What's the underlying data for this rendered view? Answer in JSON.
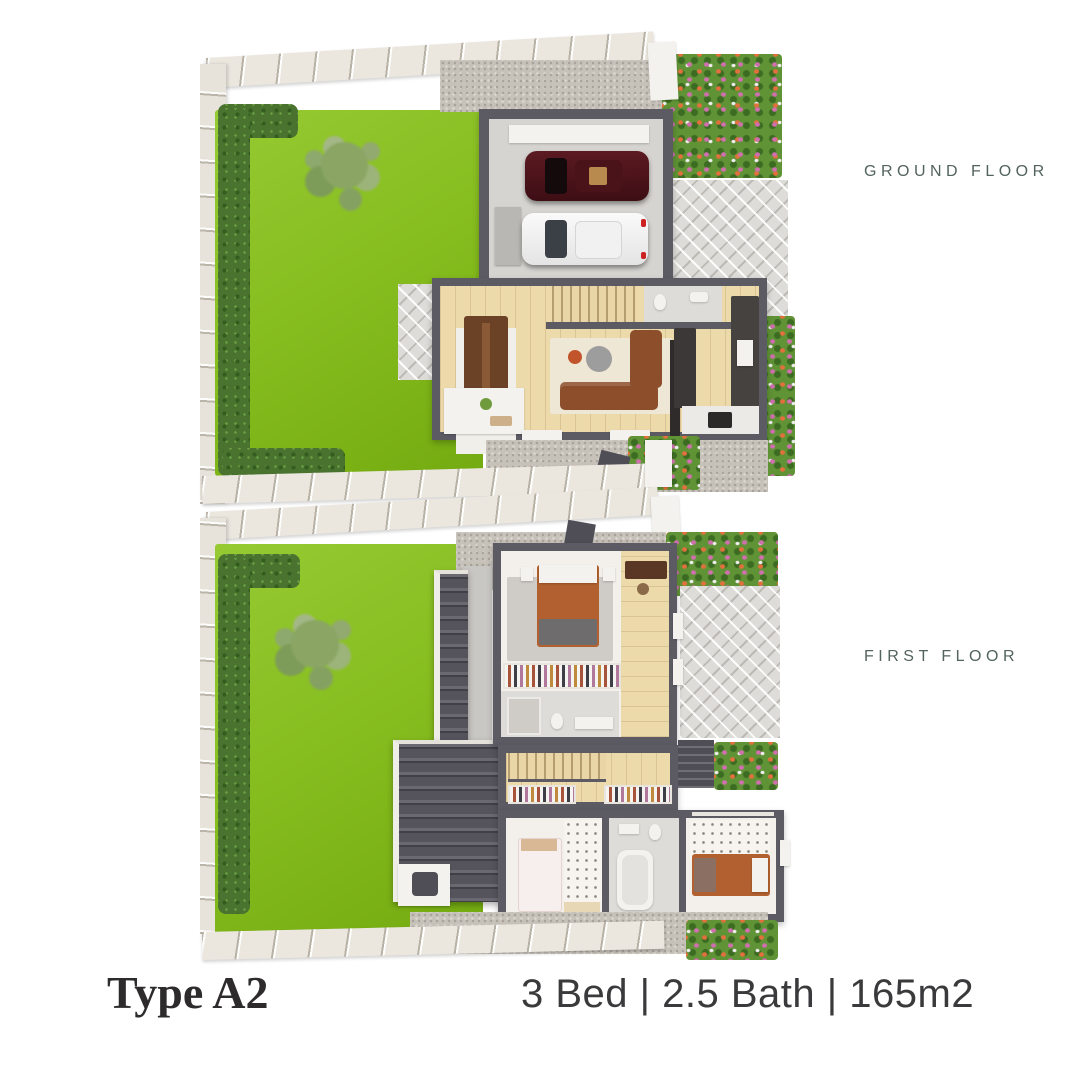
{
  "artboard": {
    "width": 1080,
    "height": 1080,
    "background": "#ffffff"
  },
  "floor_plans": [
    {
      "label": "GROUND FLOOR",
      "depicts": "lawn with tree and hedge, double garage with two cars, driveway, open-plan kitchen dining living room, wc, stairs, entry porch, paved patio and flower beds"
    },
    {
      "label": "FIRST FLOOR",
      "depicts": "lawn with tree and hedge, master bedroom with wardrobe and bathroom, two further bedrooms, bathroom with tub, stairs, landing, garage roof with skylight, paved terrace and flower beds"
    }
  ],
  "footer": {
    "type": "Type A2",
    "specs": "3 Bed | 2.5 Bath | 165m2"
  },
  "palette": {
    "lawn": "#87be20",
    "hedge": "#4a7330",
    "tree": "#8aa468",
    "fence": "#ebe7df",
    "wall": "#5c5b64",
    "wood_floor": "#eddaab",
    "gravel": "#c6c1b9",
    "paving": "#dedcd8",
    "roof": "#55545d",
    "interior": "#f3f0eb",
    "sofa": "#8c4e2b",
    "bed_accent": "#b2602f",
    "car_maroon": "#46121a",
    "car_white": "#f4f4f4",
    "floor_label_text": "#53635d",
    "footer_text": "#2d2b2c"
  }
}
